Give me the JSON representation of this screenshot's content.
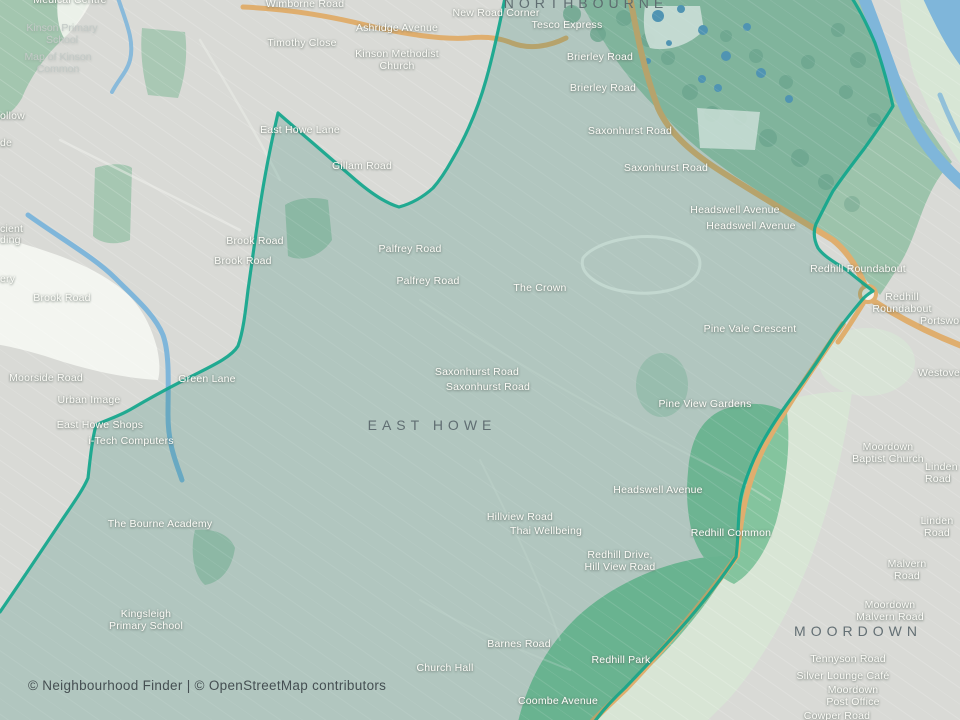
{
  "map": {
    "place": "East Howe",
    "attribution": "© Neighbourhood Finder | © OpenStreetMap contributors"
  },
  "colors": {
    "background": "#d9dad6",
    "region_fill": "rgba(18,122,102,0.20)",
    "region_stroke": "#12a68c",
    "green_area": "#9cc3ab",
    "bright_green": "#7fc29b",
    "pale_green": "#d7e6d5",
    "water": "#7fb6da",
    "major_road": "#dfae6e",
    "label_light": "#fdfdf8",
    "label_dark": "#5a676c"
  },
  "labels": {
    "areas": [
      {
        "text": "NORTHBOURNE",
        "x": 586,
        "y": 3
      },
      {
        "text": "EAST HOWE",
        "x": 432,
        "y": 425
      },
      {
        "text": "MOORDOWN",
        "x": 858,
        "y": 631
      }
    ],
    "roads_pois": [
      {
        "text": "Medical Centre",
        "x": 70,
        "y": 0
      },
      {
        "text": "Wimborne Road",
        "x": 305,
        "y": 4
      },
      {
        "text": "New Road Corner",
        "x": 496,
        "y": 13
      },
      {
        "text": "Tesco Express",
        "x": 567,
        "y": 25
      },
      {
        "text": "Ashridge Avenue",
        "x": 397,
        "y": 28
      },
      {
        "text": "Timothy Close",
        "x": 302,
        "y": 43
      },
      {
        "text": "Kinson Methodist\nChurch",
        "x": 397,
        "y": 60
      },
      {
        "text": "Brierley Road",
        "x": 600,
        "y": 57
      },
      {
        "text": "Brierley Road",
        "x": 603,
        "y": 88
      },
      {
        "text": "Saxonhurst Road",
        "x": 630,
        "y": 131
      },
      {
        "text": "Saxonhurst Road",
        "x": 666,
        "y": 168
      },
      {
        "text": "East Howe Lane",
        "x": 300,
        "y": 130
      },
      {
        "text": "Gillam Road",
        "x": 362,
        "y": 166
      },
      {
        "text": "Headswell Avenue",
        "x": 735,
        "y": 210
      },
      {
        "text": "Headswell Avenue",
        "x": 751,
        "y": 226
      },
      {
        "text": "Brook Road",
        "x": 255,
        "y": 241
      },
      {
        "text": "Brook Road",
        "x": 243,
        "y": 261
      },
      {
        "text": "Brook Road",
        "x": 62,
        "y": 298
      },
      {
        "text": "Palfrey Road",
        "x": 410,
        "y": 249
      },
      {
        "text": "Palfrey Road",
        "x": 428,
        "y": 281
      },
      {
        "text": "The Crown",
        "x": 540,
        "y": 288
      },
      {
        "text": "Redhill Roundabout",
        "x": 858,
        "y": 269
      },
      {
        "text": "Redhill Roundabout",
        "x": 902,
        "y": 303
      },
      {
        "text": "Portswood",
        "x": 920,
        "y": 321,
        "edge": "left"
      },
      {
        "text": "Pine Vale Crescent",
        "x": 750,
        "y": 329
      },
      {
        "text": "Westover",
        "x": 918,
        "y": 373,
        "edge": "left"
      },
      {
        "text": "Saxonhurst Road",
        "x": 477,
        "y": 372
      },
      {
        "text": "Saxonhurst Road",
        "x": 488,
        "y": 387
      },
      {
        "text": "Moorside Road",
        "x": 46,
        "y": 378
      },
      {
        "text": "Green Lane",
        "x": 207,
        "y": 379
      },
      {
        "text": "Urban Image",
        "x": 89,
        "y": 400
      },
      {
        "text": "East Howe Shops",
        "x": 100,
        "y": 425
      },
      {
        "text": "i-Tech Computers",
        "x": 131,
        "y": 441
      },
      {
        "text": "Pine View Gardens",
        "x": 705,
        "y": 404
      },
      {
        "text": "Moordown\nBaptist Church",
        "x": 888,
        "y": 453
      },
      {
        "text": "Linden Road",
        "x": 925,
        "y": 473,
        "edge": "left"
      },
      {
        "text": "Headswell Avenue",
        "x": 658,
        "y": 490
      },
      {
        "text": "Hillview Road",
        "x": 520,
        "y": 517
      },
      {
        "text": "Thai Wellbeing",
        "x": 546,
        "y": 531
      },
      {
        "text": "The Bourne Academy",
        "x": 160,
        "y": 524
      },
      {
        "text": "Redhill Common",
        "x": 731,
        "y": 533
      },
      {
        "text": "Linden Road",
        "x": 937,
        "y": 527
      },
      {
        "text": "Redhill Drive,\nHill View Road",
        "x": 620,
        "y": 561
      },
      {
        "text": "Malvern Road",
        "x": 907,
        "y": 570
      },
      {
        "text": "Moordown\nMalvern Road",
        "x": 890,
        "y": 611
      },
      {
        "text": "Kingsleigh\nPrimary School",
        "x": 146,
        "y": 620
      },
      {
        "text": "Barnes Road",
        "x": 519,
        "y": 644
      },
      {
        "text": "Tennyson Road",
        "x": 848,
        "y": 659
      },
      {
        "text": "Redhill Park",
        "x": 621,
        "y": 660
      },
      {
        "text": "Church Hall",
        "x": 445,
        "y": 668
      },
      {
        "text": "Silver Lounge Café",
        "x": 843,
        "y": 676
      },
      {
        "text": "Moordown\nPost Office",
        "x": 853,
        "y": 696
      },
      {
        "text": "Coombe Avenue",
        "x": 558,
        "y": 701
      },
      {
        "text": "Cowper Road",
        "x": 837,
        "y": 716
      }
    ],
    "muted": [
      {
        "text": "Kinson Primary\nSchool",
        "x": 62,
        "y": 34
      },
      {
        "text": "Map of Kinson\nCommon",
        "x": 58,
        "y": 63
      }
    ],
    "fragments": [
      {
        "text": "ollow",
        "x": 0,
        "y": 116,
        "edge": "left"
      },
      {
        "text": "de",
        "x": 0,
        "y": 143,
        "edge": "left"
      },
      {
        "text": "cient",
        "x": 0,
        "y": 229,
        "edge": "left"
      },
      {
        "text": "ding",
        "x": 0,
        "y": 240,
        "edge": "left"
      },
      {
        "text": "ery",
        "x": 0,
        "y": 279,
        "edge": "left"
      }
    ]
  }
}
